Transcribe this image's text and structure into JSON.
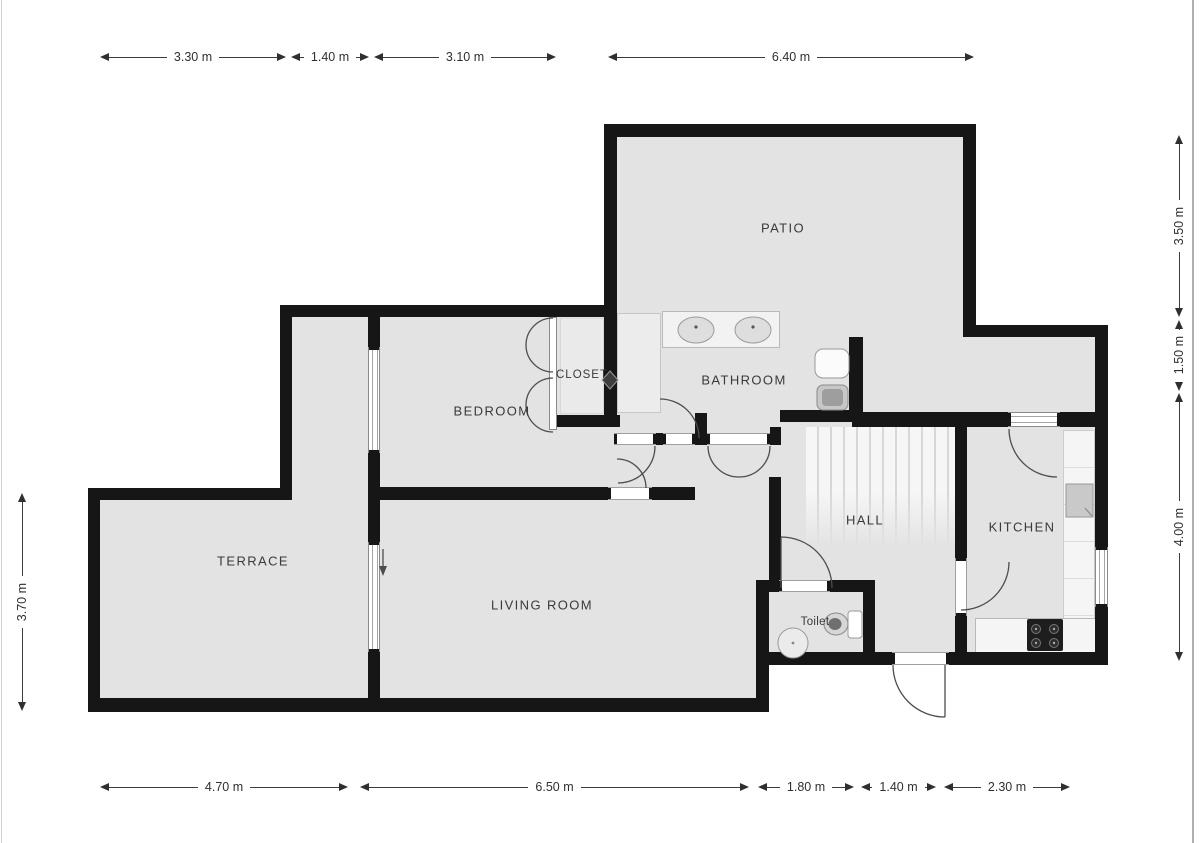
{
  "title": "Apartment floor plan",
  "plan": {
    "rooms": [
      {
        "id": "patio",
        "label": "PATIO"
      },
      {
        "id": "closet",
        "label": "CLOSET"
      },
      {
        "id": "bathroom",
        "label": "BATHROOM"
      },
      {
        "id": "bedroom",
        "label": "BEDROOM"
      },
      {
        "id": "hall",
        "label": "HALL"
      },
      {
        "id": "kitchen",
        "label": "KITCHEN"
      },
      {
        "id": "terrace",
        "label": "TERRACE"
      },
      {
        "id": "living_room",
        "label": "LIVING ROOM"
      },
      {
        "id": "toilet",
        "label": "Toilet"
      }
    ],
    "dimensions": {
      "top": [
        {
          "label": "3.30 m",
          "meters": 3.3
        },
        {
          "label": "1.40 m",
          "meters": 1.4
        },
        {
          "label": "3.10 m",
          "meters": 3.1
        },
        {
          "label": "6.40 m",
          "meters": 6.4
        }
      ],
      "bottom": [
        {
          "label": "4.70 m",
          "meters": 4.7
        },
        {
          "label": "6.50 m",
          "meters": 6.5
        },
        {
          "label": "1.80 m",
          "meters": 1.8
        },
        {
          "label": "1.40 m",
          "meters": 1.4
        },
        {
          "label": "2.30 m",
          "meters": 2.3
        }
      ],
      "left": [
        {
          "label": "3.70 m",
          "meters": 3.7
        }
      ],
      "right": [
        {
          "label": "3.50 m",
          "meters": 3.5
        },
        {
          "label": "1.50 m",
          "meters": 1.5
        },
        {
          "label": "4.00 m",
          "meters": 4.0
        }
      ]
    },
    "fixtures": [
      "staircase",
      "double-vanity-sinks",
      "shower-cabinet",
      "bathtub",
      "bidet",
      "toilet-bowl",
      "hand-basin",
      "kitchen-sink",
      "stove-hob",
      "kitchen-counters",
      "closet-bifold-doors",
      "entrance-door"
    ],
    "colors": {
      "wall": "#161616",
      "floor": "#e3e3e4",
      "background": "#ffffff",
      "fixture_light": "#f4f4f4",
      "stroke": "#4d4d4d"
    }
  }
}
